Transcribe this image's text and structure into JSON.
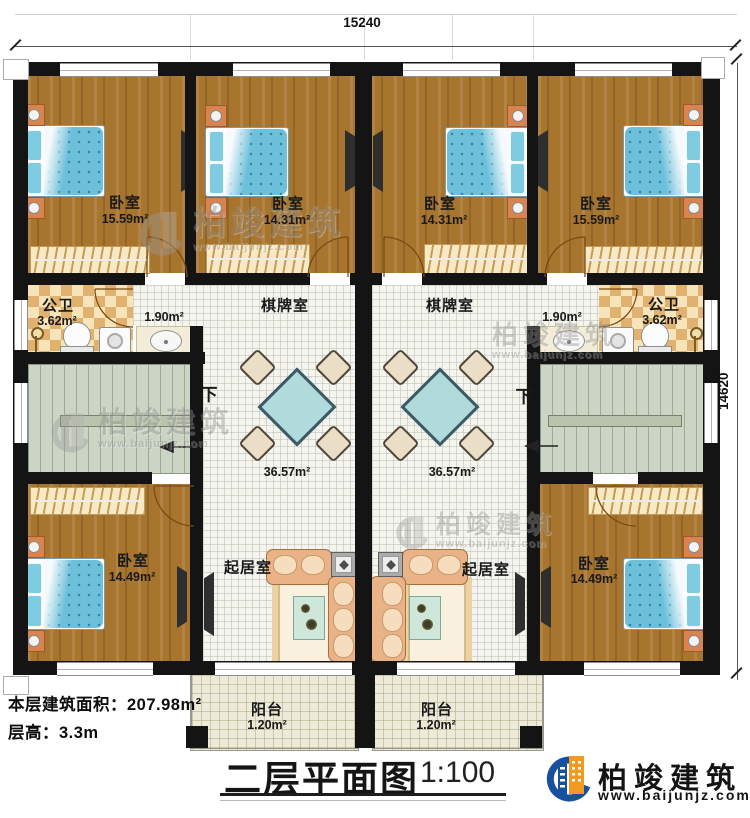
{
  "dimensions": {
    "width_top": "15240",
    "height_right": "14620"
  },
  "rooms": {
    "bedroom_top_left": {
      "label": "卧室",
      "area": "15.59m²"
    },
    "bedroom_top_left2": {
      "label": "卧室",
      "area": "14.31m²"
    },
    "bedroom_top_right2": {
      "label": "卧室",
      "area": "14.31m²"
    },
    "bedroom_top_right": {
      "label": "卧室",
      "area": "15.59m²"
    },
    "bathroom_left": {
      "label": "公卫",
      "area": "3.62m²"
    },
    "bathroom_right": {
      "label": "公卫",
      "area": "3.62m²"
    },
    "washbasin_left": {
      "area": "1.90m²"
    },
    "washbasin_right": {
      "area": "1.90m²"
    },
    "game_room_left": {
      "label": "棋牌室",
      "area": "36.57m²"
    },
    "game_room_right": {
      "label": "棋牌室",
      "area": "36.57m²"
    },
    "living_room_left": {
      "label": "起居室"
    },
    "living_room_right": {
      "label": "起居室"
    },
    "bedroom_bottom_left": {
      "label": "卧室",
      "area": "14.49m²"
    },
    "bedroom_bottom_right": {
      "label": "卧室",
      "area": "14.49m²"
    },
    "balcony_left": {
      "label": "阳台",
      "area": "1.20m²"
    },
    "balcony_right": {
      "label": "阳台",
      "area": "1.20m²"
    }
  },
  "stairs": {
    "left_label": "下",
    "right_label": "下"
  },
  "notes": {
    "floor_area": "本层建筑面积：207.98m²",
    "floor_height": "层高：3.3m"
  },
  "footer": {
    "title": "二层平面图",
    "scale": "1:100"
  },
  "logo": {
    "company": "柏竣建筑",
    "website": "www.baijunjz.com"
  },
  "watermark": {
    "company": "柏竣建筑",
    "website": "www.baijunjz.com"
  },
  "colors": {
    "wall": "#141414",
    "wood_floor": "#a8752f",
    "bed_blue": "#6cc0da",
    "checker_tan": "#e1b170",
    "stairs_green": "#ccd4c5",
    "logo_blue": "#17519e",
    "logo_orange": "#f29a1f"
  }
}
